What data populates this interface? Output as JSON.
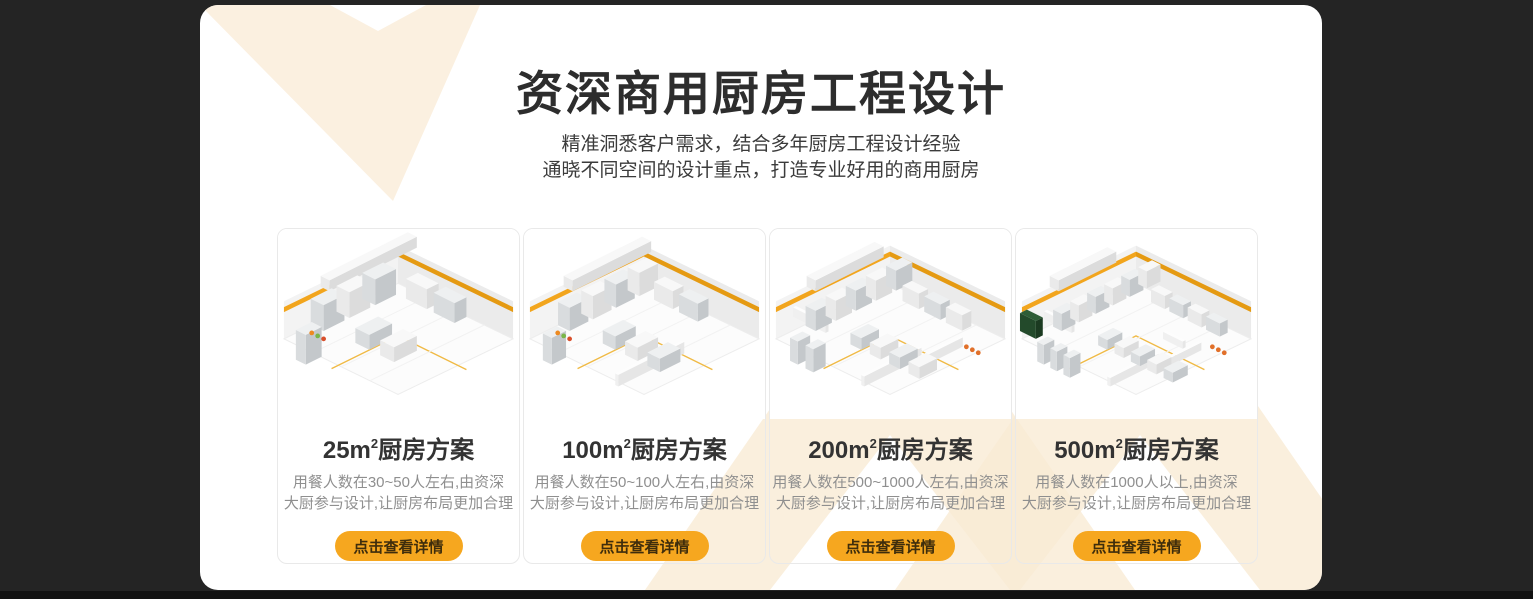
{
  "theme": {
    "background": "#242424",
    "panel": "#ffffff",
    "cream": "#FBF0E0",
    "cream2": "#F9EBD4",
    "orange": "#F6A71F",
    "title_ink": "#2d2d2d",
    "desc_ink": "#8f8f8f",
    "button_ink": "#3E2D0C"
  },
  "header": {
    "title": "资深商用厨房工程设计",
    "subtitle_line1": "精准洞悉客户需求，结合多年厨房工程设计经验",
    "subtitle_line2": "通晓不同空间的设计重点，打造专业好用的商用厨房"
  },
  "cards": [
    {
      "title_prefix": "25m",
      "title_sup": "2",
      "title_suffix": "厨房方案",
      "desc_line1": "用餐人数在30~50人左右,由资深",
      "desc_line2": "大厨参与设计,让厨房布局更加合理",
      "button_label": "点击查看详情",
      "image_alt": "isometric-25m2-kitchen-render"
    },
    {
      "title_prefix": "100m",
      "title_sup": "2",
      "title_suffix": "厨房方案",
      "desc_line1": "用餐人数在50~100人左右,由资深",
      "desc_line2": "大厨参与设计,让厨房布局更加合理",
      "button_label": "点击查看详情",
      "image_alt": "isometric-100m2-kitchen-render"
    },
    {
      "title_prefix": "200m",
      "title_sup": "2",
      "title_suffix": "厨房方案",
      "desc_line1": "用餐人数在500~1000人左右,由资深",
      "desc_line2": "大厨参与设计,让厨房布局更加合理",
      "button_label": "点击查看详情",
      "image_alt": "isometric-200m2-kitchen-render"
    },
    {
      "title_prefix": "500m",
      "title_sup": "2",
      "title_suffix": "厨房方案",
      "desc_line1": "用餐人数在1000人以上,由资深",
      "desc_line2": "大厨参与设计,让厨房布局更加合理",
      "button_label": "点击查看详情",
      "image_alt": "isometric-500m2-kitchen-render"
    }
  ]
}
